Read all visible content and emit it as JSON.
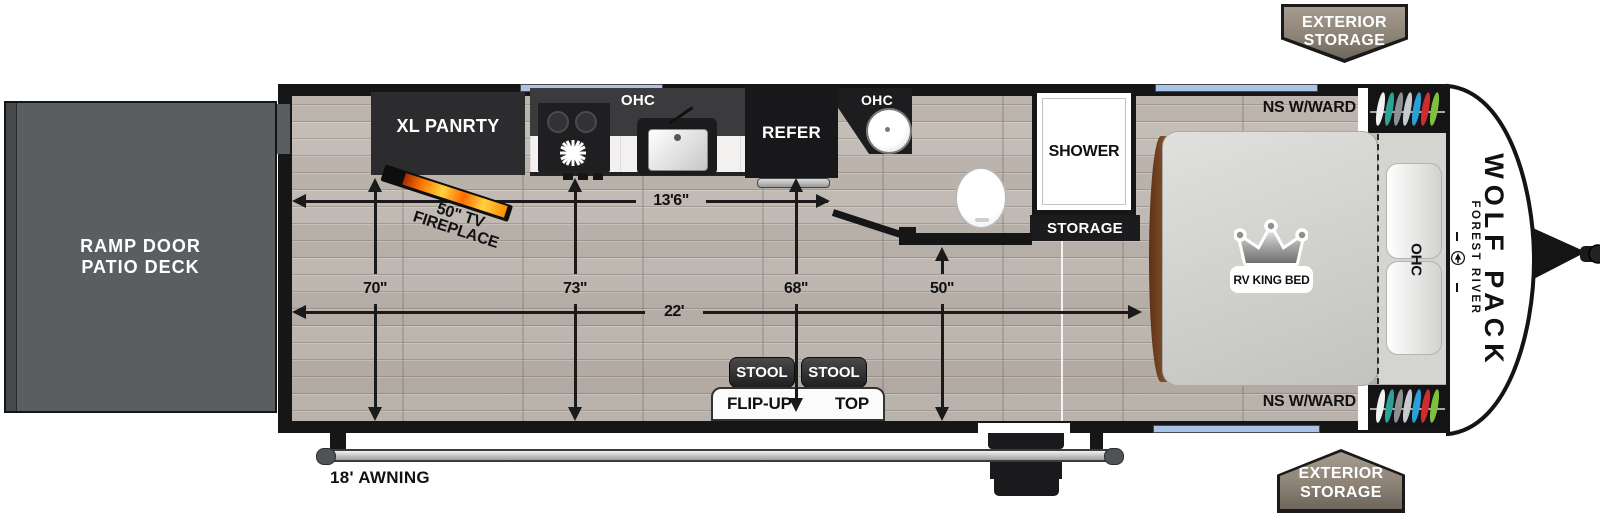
{
  "deck": {
    "line1": "RAMP DOOR",
    "line2": "PATIO DECK"
  },
  "badges": {
    "line1": "EXTERIOR",
    "line2": "STORAGE"
  },
  "kitchen": {
    "pantry": "XL PANRTY",
    "ohc_left": "OHC",
    "ohc_right": "OHC",
    "refer": "REFER"
  },
  "bath": {
    "shower": "SHOWER",
    "storage": "STORAGE"
  },
  "bedroom": {
    "ns_top": "NS W/WARD",
    "ns_bottom": "NS W/WARD",
    "bed": "RV KING BED",
    "ohc": "OHC",
    "hanger_colors": [
      "#f2f2f2",
      "#2ba396",
      "#8e9092",
      "#c7cbcd",
      "#2b9fd6",
      "#cf2d2d",
      "#7fc13d"
    ]
  },
  "living": {
    "stool1": "STOOL",
    "stool2": "STOOL",
    "flip_left": "FLIP-UP",
    "flip_right": "TOP",
    "fireplace_line1": "50\" TV",
    "fireplace_line2": "FIREPLACE"
  },
  "dimensions": {
    "w13_6": "13'6\"",
    "l22": "22'",
    "v70": "70\"",
    "v73": "73\"",
    "v68": "68\"",
    "v50": "50\"",
    "awning": "18' AWNING"
  },
  "brand": {
    "make": "FOREST RIVER",
    "model": "WOLF PACK"
  },
  "colors": {
    "window_blue": "#a9c4e6",
    "badge_taupe": "#8d8377",
    "deck_gray": "#5a5e60",
    "flame_orange": "#ff7a00"
  }
}
